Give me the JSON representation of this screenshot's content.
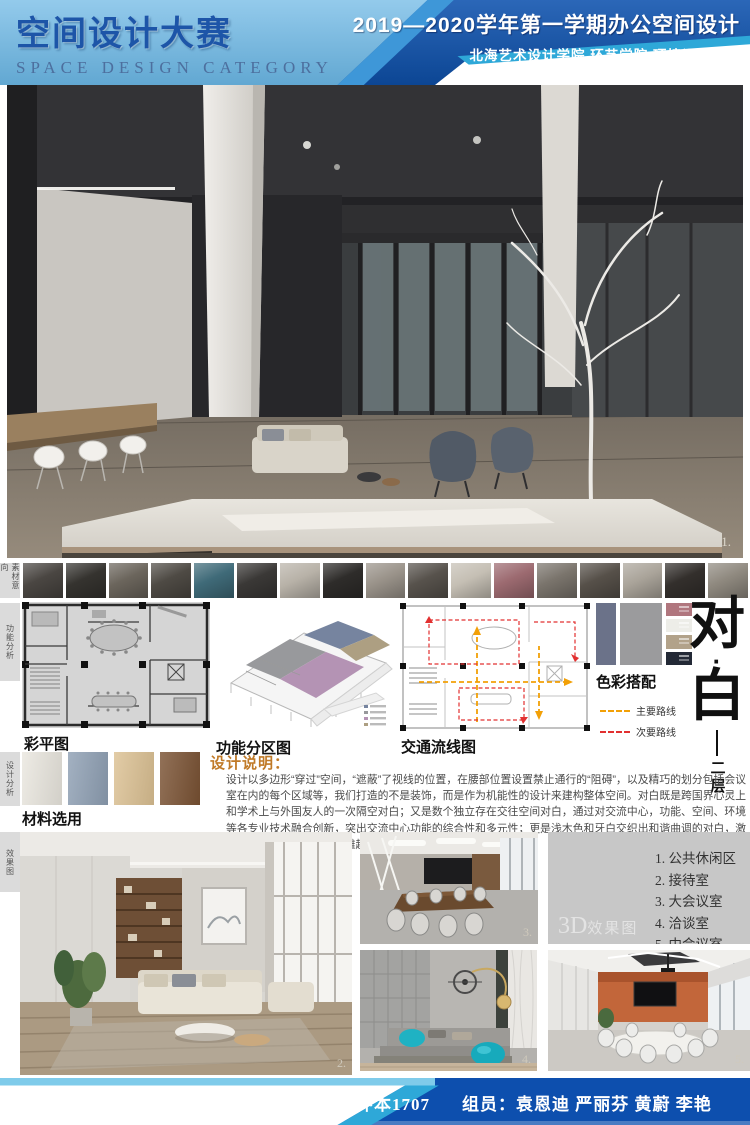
{
  "header": {
    "title_cn": "空间设计大赛",
    "title_en": "SPACE DESIGN CATEGORY",
    "course_line": "2019—2020学年第一学期办公空间设计",
    "school_line": "北海艺术设计学院  环艺学院  环境设计专业"
  },
  "colors": {
    "header_light": "#6ab6e4",
    "header_mid": "#3e97d8",
    "header_dark": "#0e52ae",
    "accent_teal": "#2ea8d8",
    "footer_blue": "#0d4fae",
    "note_heading": "#c07a28"
  },
  "hero": {
    "page_marker": "1."
  },
  "sidebar_labels": [
    "素材意向",
    "功能分析",
    "设计分析",
    "效果图"
  ],
  "strip": {
    "thumbs": [
      "#4a4642",
      "#35332f",
      "#6b655c",
      "#4e4a44",
      "#3f6a78",
      "#3a3836",
      "#b8b2a8",
      "#2e2c2a",
      "#9a938a",
      "#57524c",
      "#c5bfb4",
      "#9c6a70",
      "#7a746c",
      "#565049",
      "#aaa49a",
      "#332f2c",
      "#8f897f"
    ]
  },
  "analysis": {
    "plan_caption": "彩平图",
    "axon_caption": "功能分区图",
    "circulation_caption": "交通流线图",
    "palette_caption": "色彩搭配",
    "legend": [
      {
        "label": "主要路线"
      },
      {
        "label": "次要路线"
      }
    ],
    "legend_colors": [
      "#f2a007",
      "#e23030"
    ],
    "palette": {
      "large": [
        "#6b7289",
        "#9b9b9d"
      ],
      "small": [
        "#b0767e",
        "#edede8",
        "#b2a28a",
        "#232936"
      ]
    },
    "vertical_title_chars": [
      "对",
      "·",
      "白"
    ],
    "floor_label": "二层"
  },
  "materials": {
    "caption": "材料选用",
    "swatches": [
      "#eae7df",
      "#8fa0b4",
      "#dcc193",
      "#7a5233",
      "#caa46b"
    ]
  },
  "design_note": {
    "heading": "设计说明：",
    "body": "设计以多边形“穿过”空间，“遮蔽”了视线的位置，在腰部位置设置禁止通行的“阻碍”，以及精巧的划分包括会议室在内的每个区域等，我们打造的不是装饰，而是作为机能性的设计来建构整体空间。对白既是跨国界心灵上和学术上与外国友人的一次隔空对白；又是数个独立存在交往空间对白，通过对交流中心，功能、空间、环境等各专业技术融合创新，突出交流中心功能的综合性和多元性；更是浅木色和牙白交织出和谐曲调的对白，激起幽幽黛蓝，宕起空间的雅趣。"
  },
  "renders": {
    "label_3d_prefix": "3D",
    "label_3d_suffix": "效果图",
    "room_list": [
      "1. 公共休闲区",
      "2. 接待室",
      "3. 大会议室",
      "4. 洽谈室",
      "5. 中会议室"
    ],
    "markers": {
      "living": "2.",
      "conference": "3.",
      "lounge": "4.",
      "meeting": "5."
    }
  },
  "footer": {
    "class_label": "班级：环本1707",
    "members_label": "组员：袁恩迪  严丽芬  黄蔚  李艳"
  }
}
